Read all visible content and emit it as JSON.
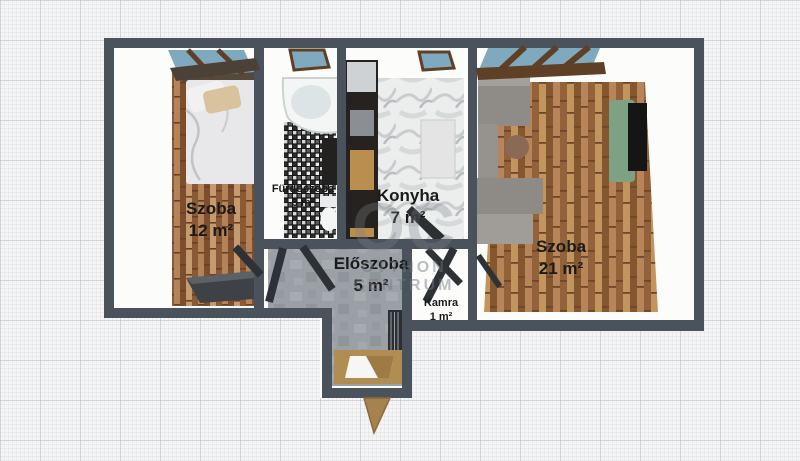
{
  "plan": {
    "title": "Apartment floor plan",
    "rooms": [
      {
        "id": "szoba-12",
        "name": "Szoba",
        "area": "12 m²"
      },
      {
        "id": "furdoszoba",
        "name": "Fürdőszoba",
        "area": "3 m²"
      },
      {
        "id": "konyha",
        "name": "Konyha",
        "area": "7 m²"
      },
      {
        "id": "eloszoba",
        "name": "Előszoba",
        "area": "5 m²"
      },
      {
        "id": "kamra",
        "name": "Kamra",
        "area": "1 m²"
      },
      {
        "id": "szoba-21",
        "name": "Szoba",
        "area": "21 m²"
      }
    ],
    "watermark": {
      "monogram": "OC",
      "line1": "OTTHON",
      "line2": "CENTRUM"
    },
    "colors": {
      "wall": "#4a525b",
      "wood_floor_small_room": "#9a6a42",
      "parquet_floor_large_room": "#a9794c",
      "marble_floor": "#eceded",
      "concrete_floor": "#9aa0a5",
      "mosaic_tile": "#1a1a1a",
      "window_glass": "#7fa9bf",
      "window_frame_wood": "#5f4026",
      "sofa_green": "#7ca183",
      "entry_door_wood": "#a5824e",
      "paper_background": "#f5f5f6"
    }
  }
}
